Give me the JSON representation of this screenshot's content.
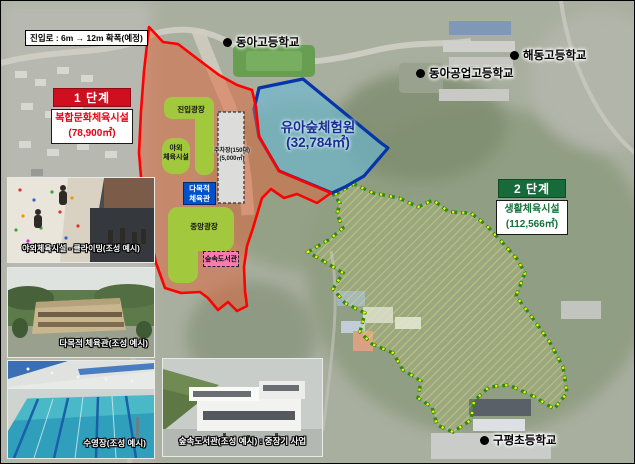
{
  "map": {
    "entry_note": "진입로 : 6m → 12m 확폭(예정)",
    "schools": [
      {
        "name": "동아고등학교"
      },
      {
        "name": "해동고등학교"
      },
      {
        "name": "동아공업고등학교"
      },
      {
        "name": "구평초등학교"
      }
    ],
    "phase1": {
      "title": "1 단계",
      "facility": "복합문화체육시설",
      "area": "(78,900㎡)"
    },
    "phase2": {
      "title": "2 단계",
      "facility": "생활체육시설",
      "area": "(112,566㎡)"
    },
    "forest_zone": {
      "name": "유아숲체험원",
      "area": "(32,784㎡)"
    },
    "features": {
      "entry_plaza": "진입광장",
      "outdoor_line1": "야외",
      "outdoor_line2": "체육시설",
      "parking_line1": "주차장(150대)",
      "parking_line2": "(5,000㎡)",
      "gym_line1": "다목적",
      "gym_line2": "체육관",
      "central_plaza": "중앙광장",
      "library": "숲속도서관"
    },
    "photos": [
      {
        "caption": "야외체육시설 - 클라이밍(조성 예시)"
      },
      {
        "caption": "다목적 체육관(조성 예시)"
      },
      {
        "caption": "수영장(조성 예시)"
      },
      {
        "caption": "숲속도서관(조성 예시) : 중장기 사업"
      }
    ],
    "colors": {
      "phase1_boundary": "#ff0000",
      "phase1_fill": "#e26238",
      "phase1_badge": "#cf0f1f",
      "phase1_text": "#e60012",
      "phase2_boundary_green": "#2b8a12",
      "phase2_boundary_yellow": "#ffee00",
      "phase2_badge": "#176b3a",
      "forest_boundary": "#0535a8",
      "forest_fill": "#69b9d7",
      "forest_text": "#182c92",
      "plaza_green": "#a2c93e",
      "gym_blue": "#0052cc",
      "library_pink": "#f97bb1",
      "parking_gray": "#dcdcda"
    }
  }
}
